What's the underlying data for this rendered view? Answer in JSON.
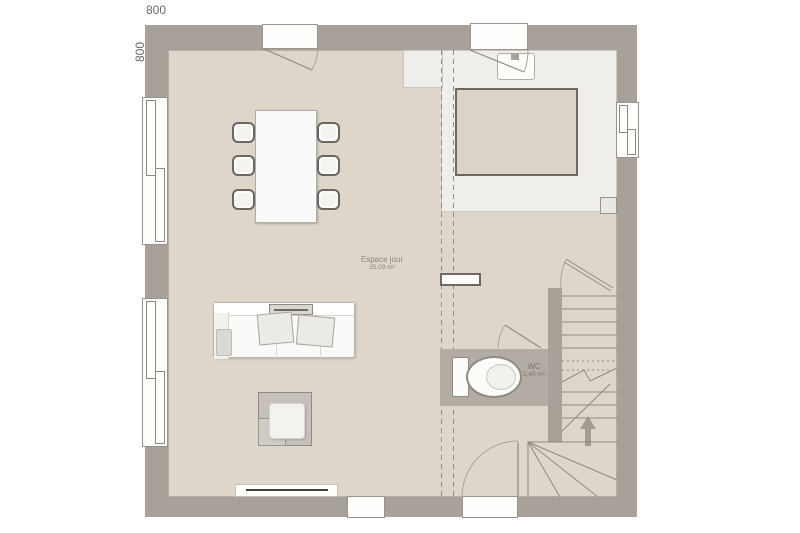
{
  "dimensions": {
    "width_label": "800",
    "height_label": "800"
  },
  "rooms": {
    "living": {
      "name": "Espace jour",
      "area": "35,09 m²"
    },
    "wc": {
      "name": "WC",
      "area": "1,40 m²"
    }
  },
  "icons": {
    "dining_table": "dining-table-icon",
    "chairs": "chair-icon",
    "sofa": "sofa-icon",
    "side_table": "side-table-icon",
    "toilet": "toilet-icon",
    "sink": "kitchen-sink-icon",
    "stairs": "staircase-icon",
    "up_arrow": "stairs-up-arrow-icon",
    "radiator": "radiator-icon"
  },
  "colors": {
    "background": "#ffffff",
    "wall": "#a7a199",
    "floor": "#ded6cb",
    "kitchen_floor": "#efeeeb",
    "island_fill": "#dcd3c8",
    "island_border": "#6f6a61",
    "wc_floor": "#b2aca4",
    "line": "#8f8a82",
    "text": "#8d857b"
  }
}
